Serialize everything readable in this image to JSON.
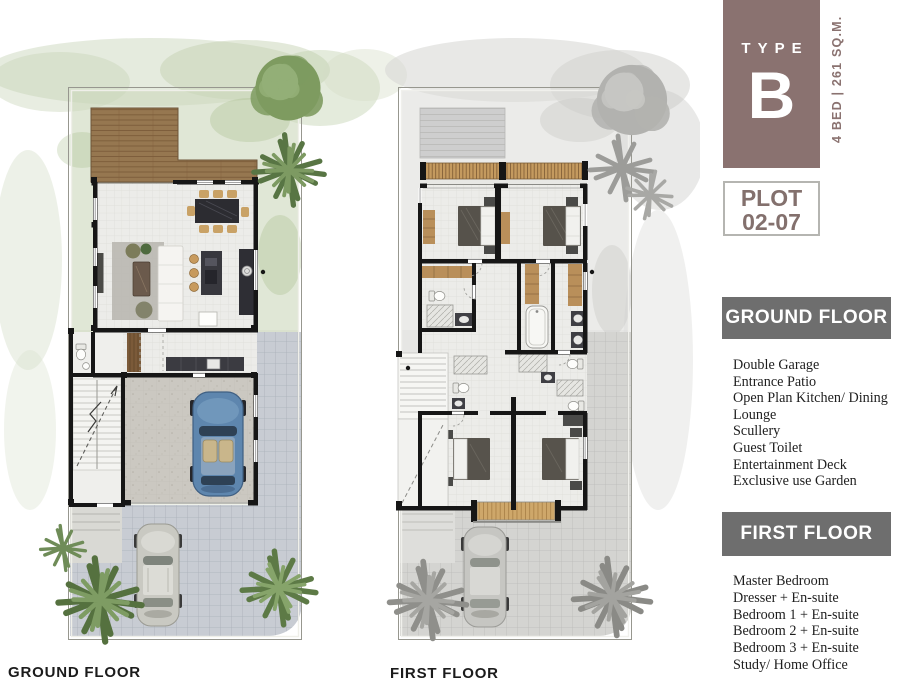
{
  "badge": {
    "label": "TYPE",
    "letter": "B",
    "spec": "4 BED | 261 SQ.M."
  },
  "plot_box": {
    "line1": "PLOT",
    "line2": "02-07"
  },
  "legend": {
    "ground": {
      "title": "GROUND FLOOR",
      "items": [
        "Double Garage",
        "Entrance Patio",
        "Open Plan Kitchen/ Dining",
        "Lounge",
        "Scullery",
        "Guest Toilet",
        "Entertainment Deck",
        "Exclusive use Garden"
      ]
    },
    "first": {
      "title": "FIRST FLOOR",
      "items": [
        "Master Bedroom",
        "Dresser + En-suite",
        "Bedroom 1 + En-suite",
        "Bedroom 2 + En-suite",
        "Bedroom 3 + En-suite",
        "Study/ Home Office"
      ]
    }
  },
  "plan_captions": {
    "ground": "GROUND FLOOR",
    "first": "FIRST FLOOR"
  },
  "colors": {
    "accent_mauve": "#8A7270",
    "header_gray": "#6E6E6E",
    "wall_black": "#161616",
    "deck_wood": "#967750",
    "garden_green": "#CBD7BA",
    "paver_gray": "#C8CCD3",
    "car_blue": "#5E86AE"
  }
}
